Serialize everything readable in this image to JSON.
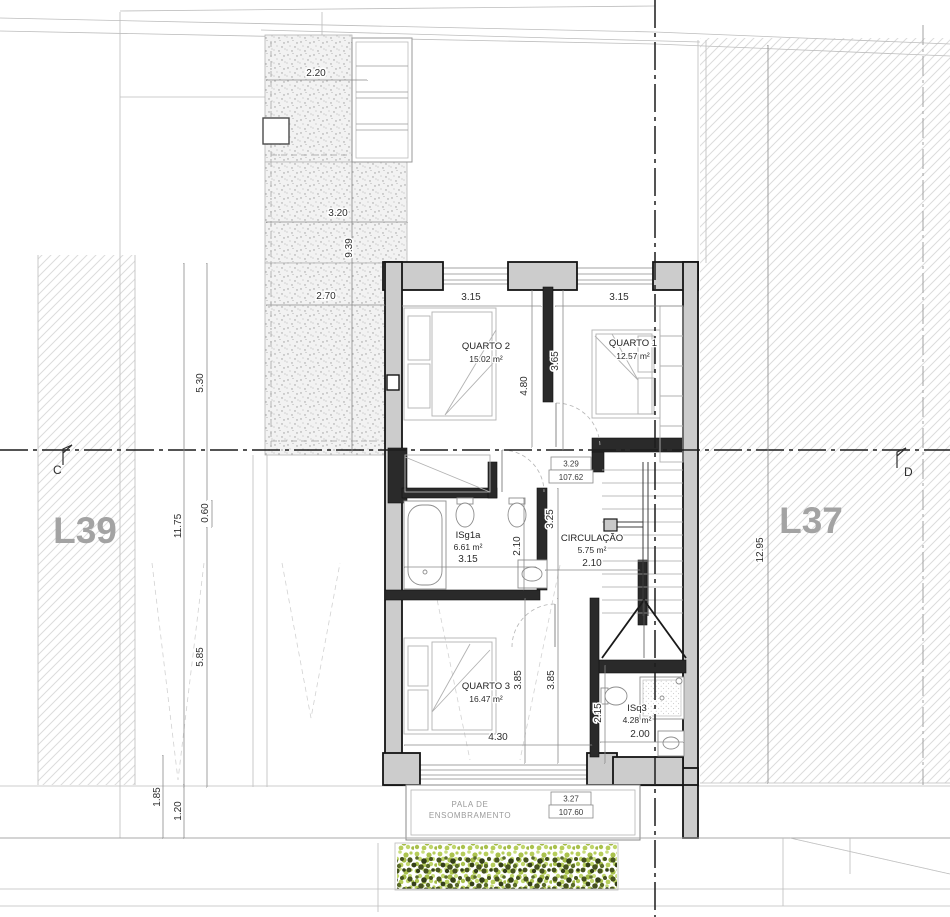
{
  "drawing": {
    "lots": {
      "left": "L39",
      "right": "L37"
    },
    "section_markers": {
      "left": "C",
      "right": "D"
    },
    "rooms": {
      "quarto2": {
        "name": "QUARTO 2",
        "area": "15.02 m²"
      },
      "quarto1": {
        "name": "QUARTO 1",
        "area": "12.57 m²"
      },
      "quarto3": {
        "name": "QUARTO 3",
        "area": "16.47 m²"
      },
      "circulacao": {
        "name": "CIRCULAÇÃO",
        "area": "5.75 m²"
      },
      "isg1a": {
        "name": "ISg1a",
        "area": "6.61 m²"
      },
      "isq3": {
        "name": "ISq3",
        "area": "4.28 m²"
      }
    },
    "canopy": {
      "line1": "PALA DE",
      "line2": "ENSOMBRAMENTO"
    },
    "levels": {
      "upper": {
        "relative": "3.29",
        "absolute": "107.62"
      },
      "lower": {
        "relative": "3.27",
        "absolute": "107.60"
      }
    },
    "dimensions": {
      "patio_top_width": "2.20",
      "patio_mid_width": "3.20",
      "patio_bottom_width": "2.70",
      "patio_length": "9.39",
      "front_yard_depth": "5.30",
      "left_lot_depth": "11.75",
      "ledge_offset": "0.60",
      "back_yard_depth": "5.85",
      "rear_setback_a": "1.85",
      "rear_setback_b": "1.20",
      "quarto2_width": "3.15",
      "quarto1_width": "3.15",
      "quarto2_depth": "4.80",
      "quarto1_depth": "3.65",
      "hall_depth": "3.25",
      "isg1a_depth": "2.10",
      "isg1a_width": "3.15",
      "circulacao_width": "2.10",
      "quarto3_width": "4.30",
      "quarto3_depth_left": "3.85",
      "quarto3_depth_right": "3.85",
      "isq3_depth": "2.15",
      "isq3_width": "2.00",
      "right_lot_depth": "12.95"
    },
    "colors": {
      "hedge_light": "#b6cd5b",
      "hedge_dark": "#46521f",
      "hatch": "#d9d9d9",
      "lot_label": "#a3a3a3"
    }
  }
}
